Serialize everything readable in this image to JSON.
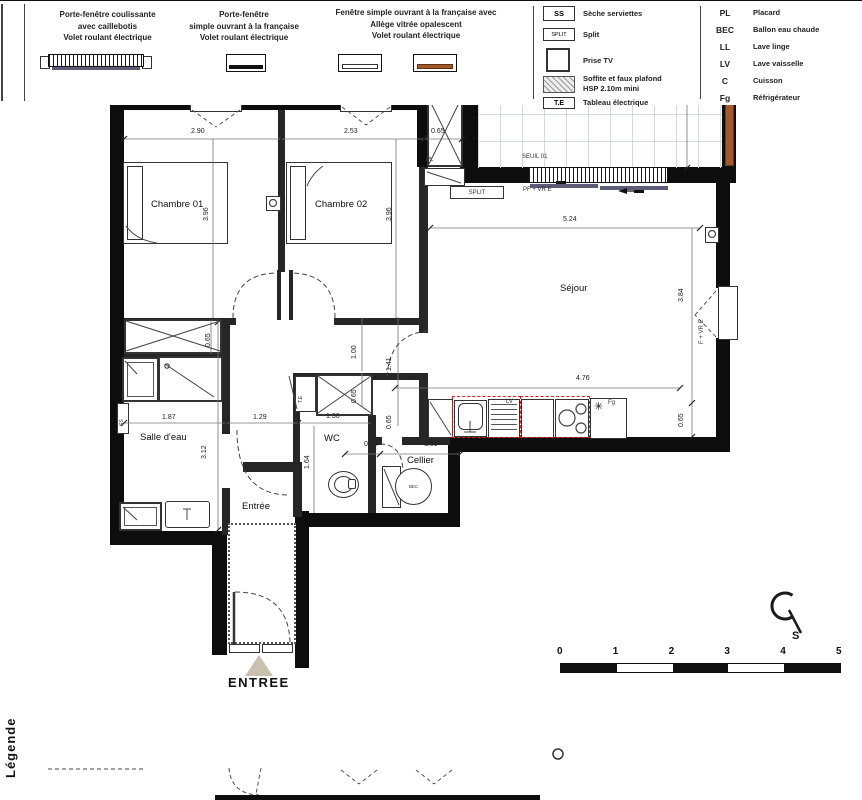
{
  "plan": {
    "labels": [
      {
        "t": "Balcon",
        "x": 560,
        "y": 90,
        "c": "room"
      },
      {
        "t": "Chambre 01",
        "x": 151,
        "y": 200,
        "c": "room"
      },
      {
        "t": "Chambre 02",
        "x": 315,
        "y": 200,
        "c": "room"
      },
      {
        "t": "Séjour",
        "x": 560,
        "y": 284,
        "c": "room"
      },
      {
        "t": "Salle d'eau",
        "x": 140,
        "y": 433,
        "c": "room"
      },
      {
        "t": "WC",
        "x": 324,
        "y": 434,
        "c": "room"
      },
      {
        "t": "Cellier",
        "x": 407,
        "y": 456,
        "c": "room"
      },
      {
        "t": "Entrée",
        "x": 242,
        "y": 502,
        "c": "room"
      },
      {
        "t": "4.44",
        "x": 587,
        "y": 37,
        "c": "dim"
      },
      {
        "t": "2.90",
        "x": 191,
        "y": 128,
        "c": "dim"
      },
      {
        "t": "2.53",
        "x": 344,
        "y": 128,
        "c": "dim"
      },
      {
        "t": "0.65",
        "x": 431,
        "y": 128,
        "c": "dim"
      },
      {
        "t": "5.24",
        "x": 563,
        "y": 216,
        "c": "dim"
      },
      {
        "t": "4.76",
        "x": 576,
        "y": 375,
        "c": "dim"
      },
      {
        "t": "1.40",
        "x": 404,
        "y": 375,
        "c": "dim"
      },
      {
        "t": "1.87",
        "x": 162,
        "y": 414,
        "c": "dim"
      },
      {
        "t": "1.29",
        "x": 253,
        "y": 414,
        "c": "dim"
      },
      {
        "t": "1.36",
        "x": 326,
        "y": 413,
        "c": "dim"
      },
      {
        "t": "0.51",
        "x": 364,
        "y": 441,
        "c": "dim"
      },
      {
        "t": "1.51",
        "x": 424,
        "y": 441,
        "c": "dim"
      },
      {
        "t": "2.49",
        "x": 676,
        "y": 104,
        "c": "dim",
        "r": 1
      },
      {
        "t": "3.96",
        "x": 203,
        "y": 221,
        "c": "dim",
        "r": 1
      },
      {
        "t": "3.96",
        "x": 386,
        "y": 221,
        "c": "dim",
        "r": 1
      },
      {
        "t": "3.84",
        "x": 678,
        "y": 302,
        "c": "dim",
        "r": 1
      },
      {
        "t": "0.65",
        "x": 678,
        "y": 427,
        "c": "dim",
        "r": 1
      },
      {
        "t": "0.65",
        "x": 205,
        "y": 347,
        "c": "dim",
        "r": 1
      },
      {
        "t": "3.12",
        "x": 201,
        "y": 459,
        "c": "dim",
        "r": 1
      },
      {
        "t": "1.64",
        "x": 304,
        "y": 469,
        "c": "dim",
        "r": 1
      },
      {
        "t": "1.00",
        "x": 351,
        "y": 359,
        "c": "dim",
        "r": 1
      },
      {
        "t": "1.41",
        "x": 386,
        "y": 371,
        "c": "dim",
        "r": 1
      },
      {
        "t": "0.65",
        "x": 386,
        "y": 429,
        "c": "dim",
        "r": 1
      },
      {
        "t": "0.65",
        "x": 351,
        "y": 403,
        "c": "dim",
        "r": 1
      },
      {
        "t": "SEUIL 01",
        "x": 522,
        "y": 154,
        "c": "note"
      },
      {
        "t": "PF + VR E",
        "x": 523,
        "y": 187,
        "c": "note"
      },
      {
        "t": "F + VR E",
        "x": 193,
        "y": 101,
        "c": "note"
      },
      {
        "t": "F + VR E",
        "x": 342,
        "y": 100,
        "c": "note"
      },
      {
        "t": "F + VR E",
        "x": 699,
        "y": 344,
        "c": "note",
        "r": 1
      },
      {
        "t": "PL",
        "x": 426,
        "y": 157,
        "c": "note"
      },
      {
        "t": "LV",
        "x": 506,
        "y": 399,
        "c": "note"
      },
      {
        "t": "Fg",
        "x": 608,
        "y": 400,
        "c": "note"
      },
      {
        "t": "T.E",
        "x": 299,
        "y": 403,
        "c": "tiny",
        "r": 1
      },
      {
        "t": "SS",
        "x": 120,
        "y": 426,
        "c": "tiny",
        "r": 1
      }
    ],
    "split_label": "SPLIT",
    "bec_label": "BEC",
    "fridge_symbol": "✳",
    "entrance_label": "ENTREE",
    "compass_south": "S",
    "scale_ticks": [
      "0",
      "1",
      "2",
      "3",
      "4",
      "5"
    ]
  },
  "legend": {
    "title": "Légende",
    "col1": [
      "Porte-fenêtre coulissante",
      "avec caillebotis",
      "Volet roulant électrique"
    ],
    "col2": [
      "Porte-fenêtre",
      "simple ouvrant à la française",
      "Volet roulant électrique"
    ],
    "col3": [
      "Fenêtre simple ouvrant à la française avec",
      "Allège vitrée opalescent",
      "Volet roulant électrique"
    ],
    "sym": [
      {
        "abbr": "SS",
        "label": "Sèche serviettes"
      },
      {
        "abbr": "SPLIT",
        "label": "Split"
      },
      {
        "abbr": "",
        "label": "Prise TV"
      },
      {
        "abbr": "",
        "label": "Soffite et faux plafond"
      },
      {
        "abbr": "T.E",
        "label": "Tableau électrique"
      }
    ],
    "soffite_line2": "HSP 2.10m mini",
    "abbr": [
      {
        "k": "PL",
        "v": "Placard"
      },
      {
        "k": "BEC",
        "v": "Ballon eau chaude"
      },
      {
        "k": "LL",
        "v": "Lave linge"
      },
      {
        "k": "LV",
        "v": "Lave vaisselle"
      },
      {
        "k": "C",
        "v": "Cuisson"
      },
      {
        "k": "Fg",
        "v": "Réfrigérateur"
      }
    ]
  }
}
